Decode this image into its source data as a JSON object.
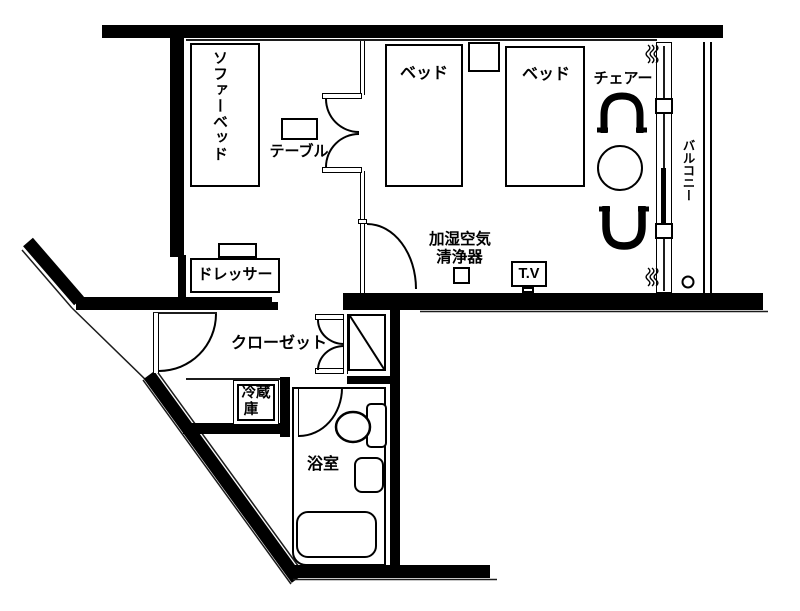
{
  "document": {
    "type": "hotel-room-floor-plan"
  },
  "labels": {
    "sofa_bed": "ソファーベッド",
    "table": "テーブル",
    "bed_left": "ベッド",
    "bed_right": "ベッド",
    "chair": "チェアー",
    "balcony": "バルコニー",
    "dresser": "ドレッサー",
    "air_purifier_line1": "加湿空気",
    "air_purifier_line2": "清浄器",
    "tv": "T.V",
    "closet": "クローゼット",
    "fridge_line1": "冷蔵",
    "fridge_line2": "庫",
    "bathroom": "浴室"
  },
  "colors": {
    "wall": "#000000",
    "line": "#1c1c1c",
    "background": "#ffffff"
  }
}
